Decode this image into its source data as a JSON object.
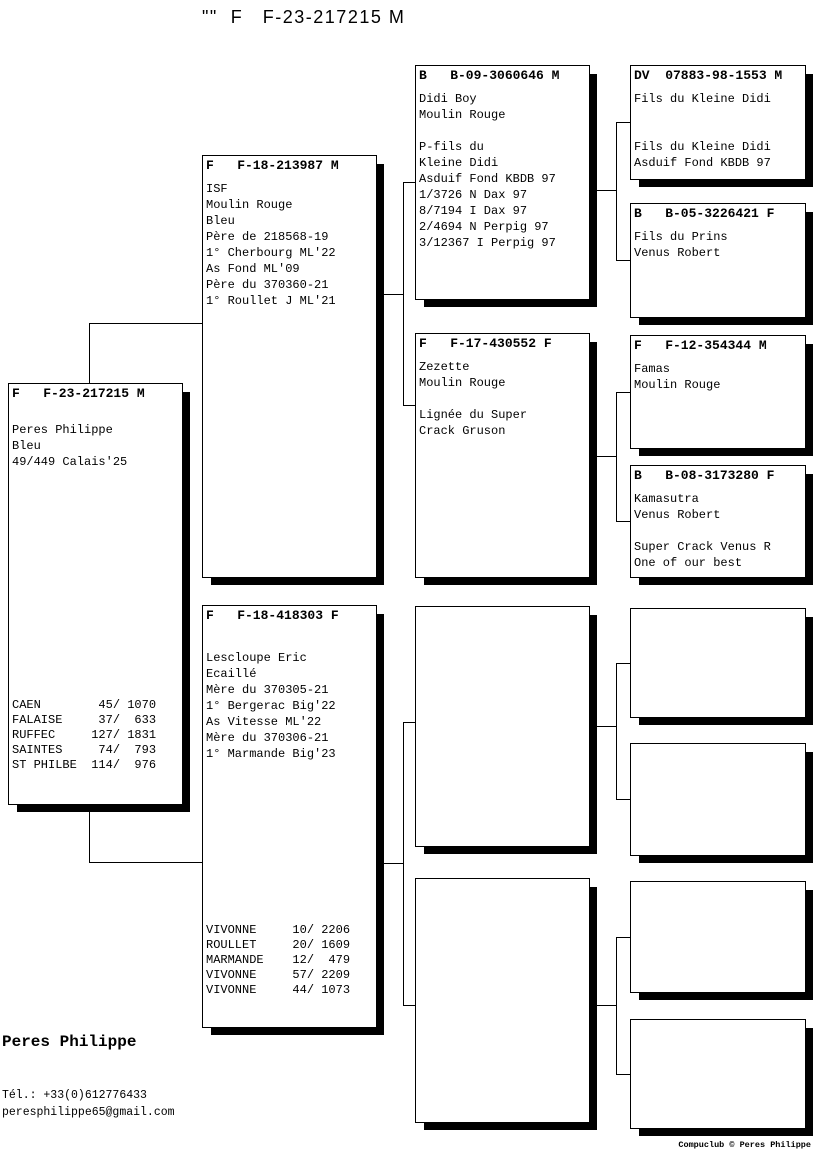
{
  "ink": "#000000",
  "title": "\"\"  F   F-23-217215 M",
  "boxes": {
    "subject": {
      "header": "F   F-23-217215 M",
      "body": "Peres Philippe\nBleu\n49/449 Calais'25",
      "results": "CAEN        45/ 1070\nFALAISE     37/  633\nRUFFEC     127/ 1831\nSAINTES     74/  793\nST PHILBE  114/  976"
    },
    "sire": {
      "header": "F   F-18-213987 M",
      "body": "ISF\nMoulin Rouge\nBleu\nPère de 218568-19\n1° Cherbourg ML'22\nAs Fond ML'09\nPère du 370360-21\n1° Roullet J ML'21"
    },
    "dam": {
      "header": "F   F-18-418303 F",
      "body": "Lescloupe Eric\nEcaillé\nMère du 370305-21\n1° Bergerac Big'22\nAs Vitesse ML'22\nMère du 370306-21\n1° Marmande Big'23",
      "results": "VIVONNE     10/ 2206\nROULLET     20/ 1609\nMARMANDE    12/  479\nVIVONNE     57/ 2209\nVIVONNE     44/ 1073"
    },
    "gg_sire_sire": {
      "header": "B   B-09-3060646 M",
      "body": "Didi Boy\nMoulin Rouge\n\nP-fils du\nKleine Didi\nAsduif Fond KBDB 97\n1/3726 N Dax 97\n8/7194 I Dax 97\n2/4694 N Perpig 97\n3/12367 I Perpig 97"
    },
    "gg_sire_dam": {
      "header": "F   F-17-430552 F",
      "body": "Zezette\nMoulin Rouge\n\nLignée du Super\nCrack Gruson"
    },
    "ggg1": {
      "header": "DV  07883-98-1553 M",
      "body": "Fils du Kleine Didi\n\n\nFils du Kleine Didi\nAsduif Fond KBDB 97"
    },
    "ggg2": {
      "header": "B   B-05-3226421 F",
      "body": "Fils du Prins\nVenus Robert"
    },
    "ggg3": {
      "header": "F   F-12-354344 M",
      "body": "Famas\nMoulin Rouge"
    },
    "ggg4": {
      "header": "B   B-08-3173280 F",
      "body": "Kamasutra\nVenus Robert\n\nSuper Crack Venus R\nOne of our best"
    }
  },
  "footer": {
    "breeder": "Peres Philippe",
    "phone": "Tél.: +33(0)612776433",
    "email": "peresphilippe65@gmail.com",
    "credit": "Compuclub © Peres Philippe"
  }
}
